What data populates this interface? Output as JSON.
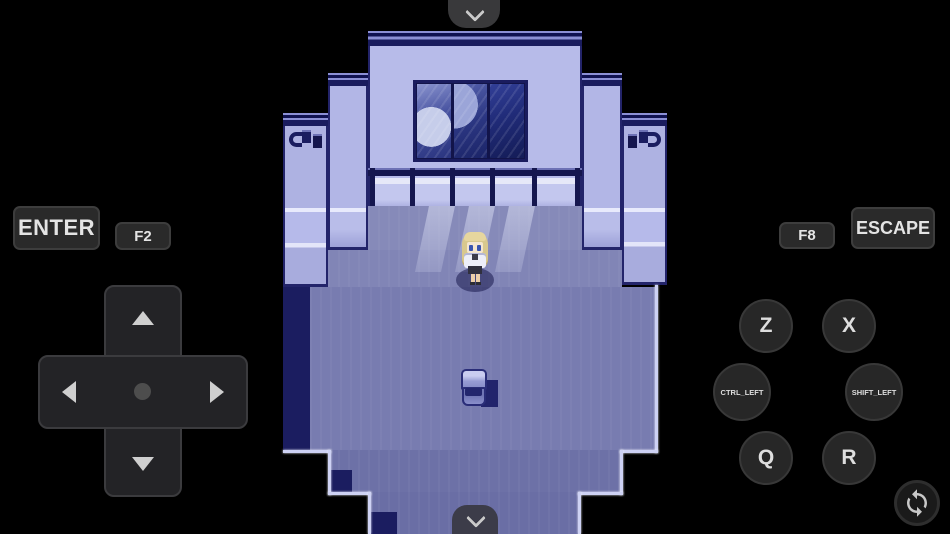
{
  "controls": {
    "toggle_top": {
      "icon": "chevron-down"
    },
    "toggle_bottom": {
      "icon": "chevron-down"
    },
    "keys": {
      "enter": "ENTER",
      "f2": "F2",
      "f8": "F8",
      "escape": "ESCAPE",
      "z": "Z",
      "x": "X",
      "ctrl_left": "CTRL_LEFT",
      "shift_left": "SHIFT_LEFT",
      "q": "Q",
      "r": "R"
    },
    "dpad": {
      "directions": [
        "up",
        "down",
        "left",
        "right"
      ]
    },
    "rotate": {
      "icon": "sync-rotate"
    },
    "colors": {
      "button_bg": "#2a2a2a",
      "button_border": "#3d3d3d",
      "button_text": "#e4e4e4"
    }
  },
  "game": {
    "colors": {
      "wall": "#b7bbe9",
      "outline": "#1b1d60",
      "floor": "#7e82b4",
      "window_glass": "#202b78",
      "background": "#000000"
    }
  }
}
